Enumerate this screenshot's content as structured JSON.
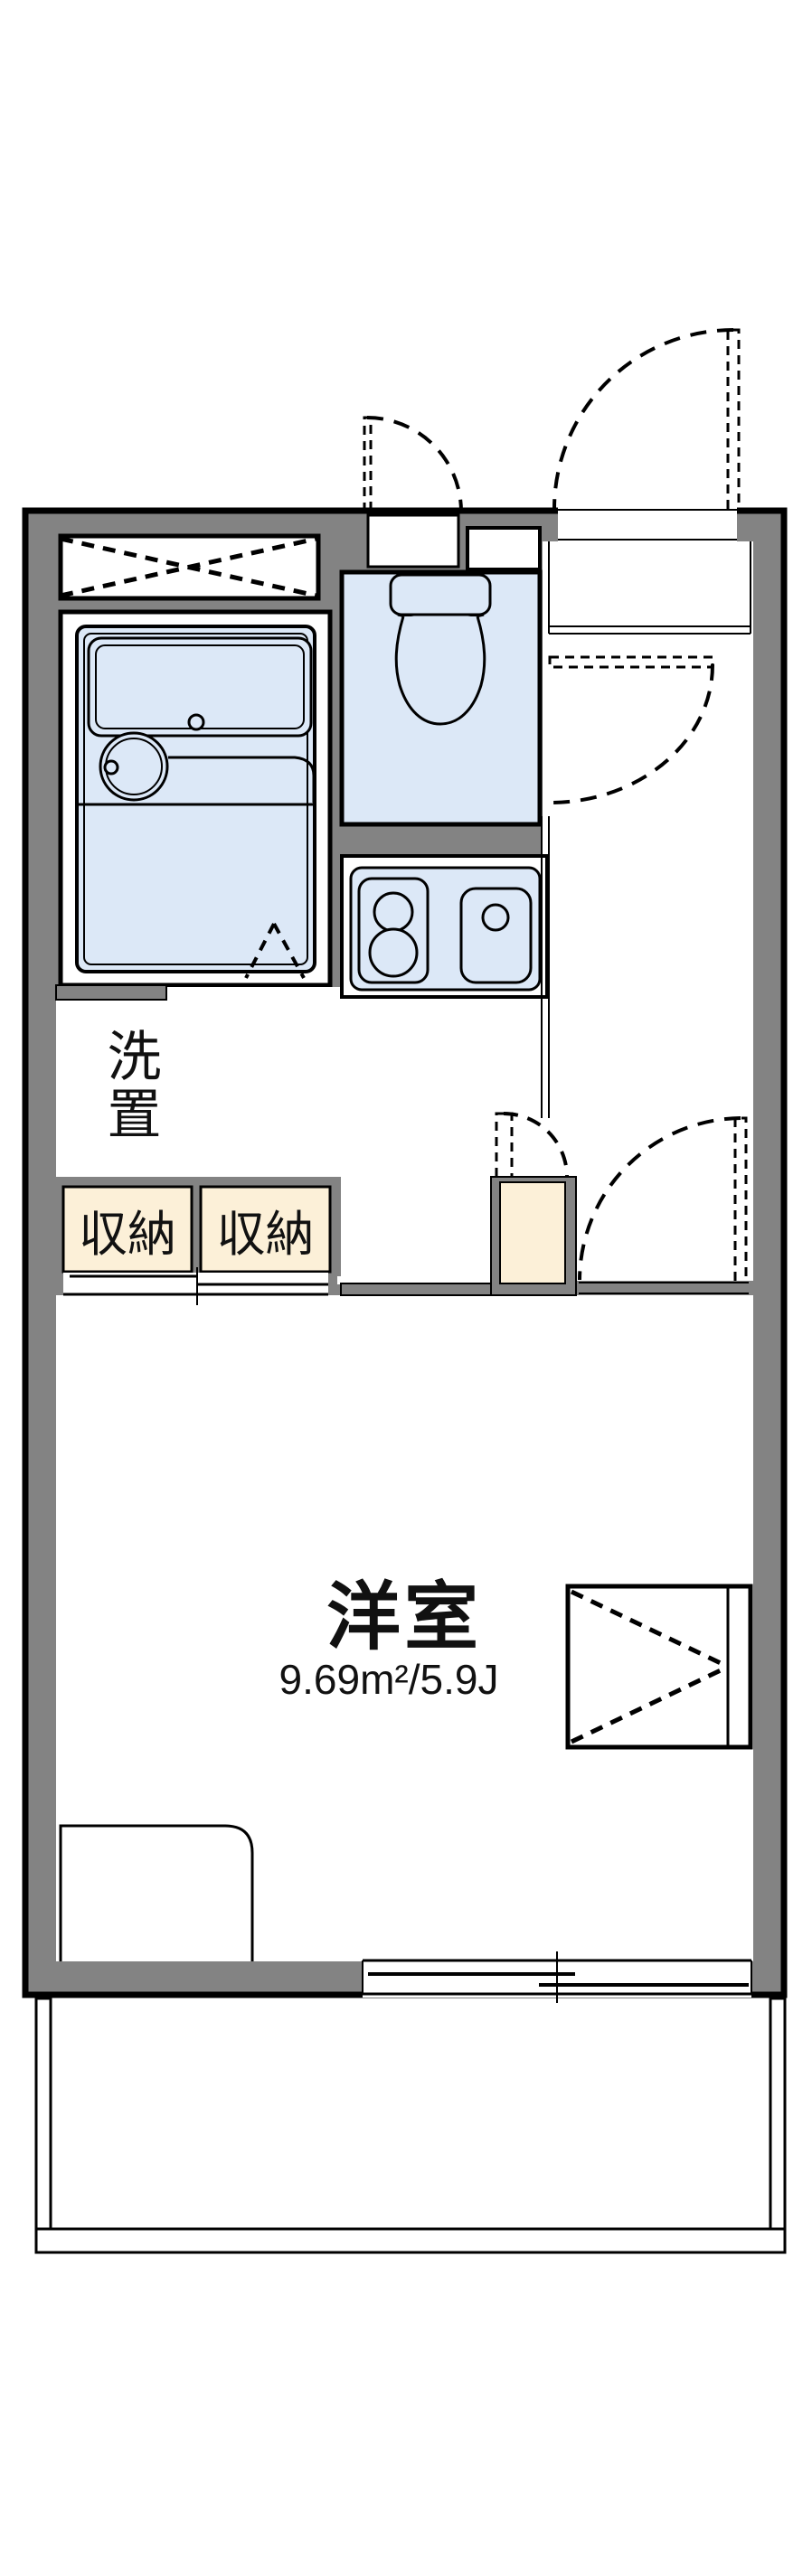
{
  "title": "apartment floor plan",
  "labels": {
    "washer": "洗置",
    "storage_left": "収納",
    "storage_right": "収納",
    "room": "洋室",
    "room_area": "9.69m²/5.9J"
  },
  "colors": {
    "wall": "#838383",
    "fixture_blue": "#dce8f7",
    "storage_cream": "#fcf0d8",
    "line": "#000000",
    "background": "#ffffff"
  }
}
